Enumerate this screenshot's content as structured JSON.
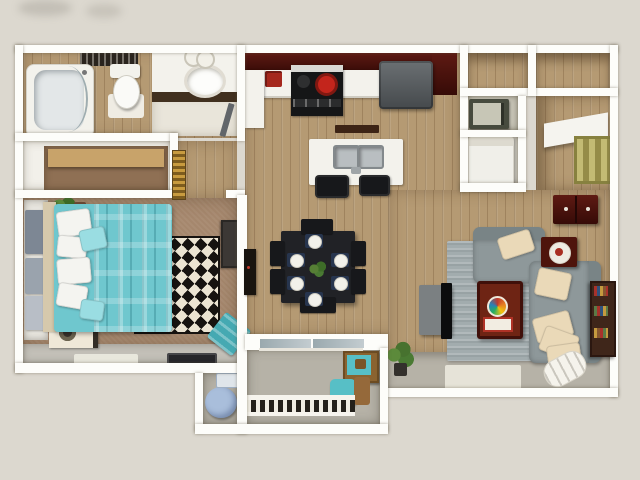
{
  "scene": {
    "kind": "3d-floorplan-render",
    "view": "top-down",
    "unit": "one-bedroom apartment with balcony"
  },
  "palette": {
    "bg": "#dcd8cf",
    "wall": "#fdfdfa",
    "wood": "#b59a73",
    "wood-dark": "#8f7450",
    "carpet": "#a5876d",
    "tile": "#e9e5da",
    "concrete": "#b6b2a7",
    "teal": "#6fc7ce",
    "teal-light": "#9adde2",
    "teal-deep": "#45a9b2",
    "maroon": "#551510",
    "maroon-deep": "#360b07",
    "counter": "#f3f2ec",
    "sofa": "#8e989a",
    "sofa-deep": "#798486",
    "cream": "#ead9b8",
    "rug-gray": "#a2acae",
    "navy": "#27354e",
    "ink": "#17181b",
    "diamond-dark": "#171310",
    "diamond-light": "#ece4d2",
    "gold": "#c89b3f",
    "olive": "#a09a58",
    "beanbag": "#a9bedb",
    "glass": "#a7b4ba",
    "wood-furn": "#8a6330",
    "green": "#4a7a33"
  },
  "rooms": [
    {
      "name": "bathroom",
      "floor": "wood+tile",
      "contents": [
        "bathtub with curved glass door",
        "toilet with mat",
        "dark bath rug",
        "vanity with round sink",
        "ceiling light"
      ]
    },
    {
      "name": "linen-closet",
      "floor": "carpet",
      "contents": [
        "tan shelf"
      ]
    },
    {
      "name": "bedroom",
      "floor": "carpet",
      "contents": [
        "teal plaid bed with white pillows",
        "two nightstands with lamps",
        "open closet with hanging clothes",
        "potted plant",
        "black-white diamond rug",
        "dresser",
        "teal throw blanket",
        "dark doormat",
        "white mat"
      ]
    },
    {
      "name": "hallway",
      "floor": "wood",
      "contents": [
        "gold striped wall art",
        "open bathroom door"
      ]
    },
    {
      "name": "kitchen",
      "floor": "wood",
      "contents": [
        "maroon upper cabinets",
        "range with red burner",
        "refrigerator",
        "white counter",
        "red small appliance",
        "island with double sink",
        "two black bar stools",
        "pendant bar"
      ]
    },
    {
      "name": "dining",
      "floor": "wood",
      "contents": [
        "black table",
        "six chairs",
        "six place settings on navy mats",
        "green centerpiece",
        "wall-mounted tv panel"
      ]
    },
    {
      "name": "entry",
      "floor": "wood",
      "contents": [
        "two closets",
        "microwave niche",
        "white washer cabinet",
        "display shelf",
        "framed olive artwork",
        "maroon wall cabinet with knobs"
      ]
    },
    {
      "name": "living-room",
      "floor": "wood+gray strip",
      "contents": [
        "gray striped rug",
        "loveseat",
        "long sofa with cream pillows",
        "maroon coffee table with board game",
        "maroon side table with bowl",
        "tv on gray stand",
        "maroon bookcase with books",
        "floor plant",
        "rolled white blanket",
        "white floor mat"
      ]
    },
    {
      "name": "balcony",
      "floor": "concrete",
      "contents": [
        "sliding glass door",
        "teal lounge chair",
        "wood side table with teal art",
        "baluster railing"
      ]
    },
    {
      "name": "storage-closet",
      "floor": "concrete",
      "contents": [
        "blue beanbag",
        "white-blue box on shelf"
      ]
    }
  ]
}
